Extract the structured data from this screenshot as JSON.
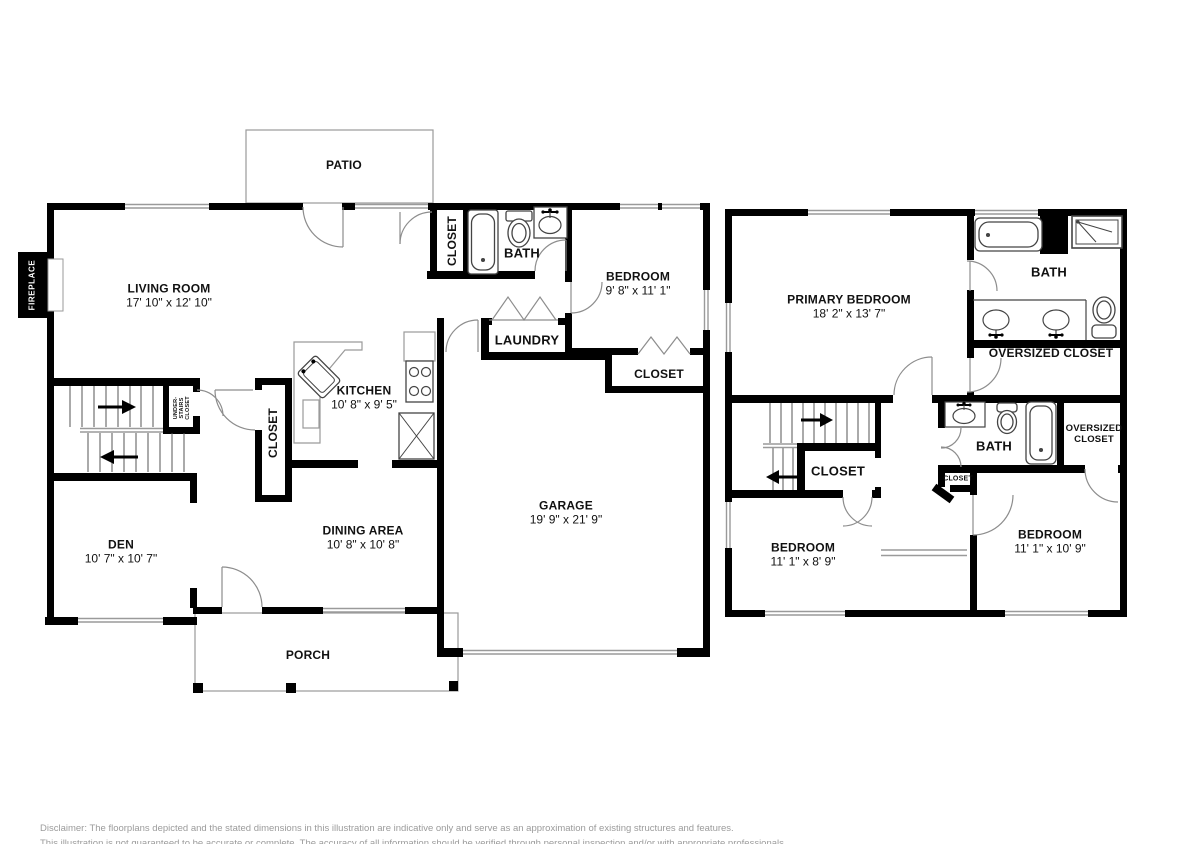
{
  "first_floor": {
    "patio": "PATIO",
    "living_room": {
      "name": "LIVING ROOM",
      "dims": "17' 10\" x 12' 10\""
    },
    "fireplace": "FIREPLACE",
    "hall_closet": "CLOSET",
    "bath": "BATH",
    "bedroom": {
      "name": "BEDROOM",
      "dims": "9' 8\" x 11' 1\""
    },
    "laundry": "LAUNDRY",
    "bedroom_closet": "CLOSET",
    "kitchen": {
      "name": "KITCHEN",
      "dims": "10' 8\" x 9' 5\""
    },
    "under_stairs_closet": {
      "line1": "UNDER-",
      "line2": "STAIRS",
      "line3": "CLOSET"
    },
    "pantry_closet": "CLOSET",
    "den": {
      "name": "DEN",
      "dims": "10' 7\" x 10' 7\""
    },
    "dining_area": {
      "name": "DINING AREA",
      "dims": "10' 8\" x 10' 8\""
    },
    "garage": {
      "name": "GARAGE",
      "dims": "19' 9\" x 21' 9\""
    },
    "porch": "PORCH"
  },
  "second_floor": {
    "primary_bedroom": {
      "name": "PRIMARY BEDROOM",
      "dims": "18' 2\" x 13' 7\""
    },
    "primary_bath": "BATH",
    "oversized_closet": "OVERSIZED CLOSET",
    "hall_closet": "CLOSET",
    "bath": "BATH",
    "bedroom_oversized_closet": {
      "line1": "OVERSIZED",
      "line2": "CLOSET"
    },
    "small_closet": "CLOSET",
    "bedroom_left": {
      "name": "BEDROOM",
      "dims": "11' 1\" x 8' 9\""
    },
    "bedroom_right": {
      "name": "BEDROOM",
      "dims": "11' 1\" x 10' 9\""
    }
  },
  "disclaimer": {
    "line1": "Disclaimer: The floorplans depicted and the stated dimensions in this illustration are indicative only and serve as an approximation of existing structures and features.",
    "line2": "This illustration is not guaranteed to be accurate or complete. The accuracy of all information should be verified through personal inspection and/or with appropriate professionals."
  },
  "colors": {
    "wall": "#000000",
    "fixture_line": "#444444",
    "light_line": "#9a9a9a",
    "disclaimer_text": "#9b9b9b"
  }
}
